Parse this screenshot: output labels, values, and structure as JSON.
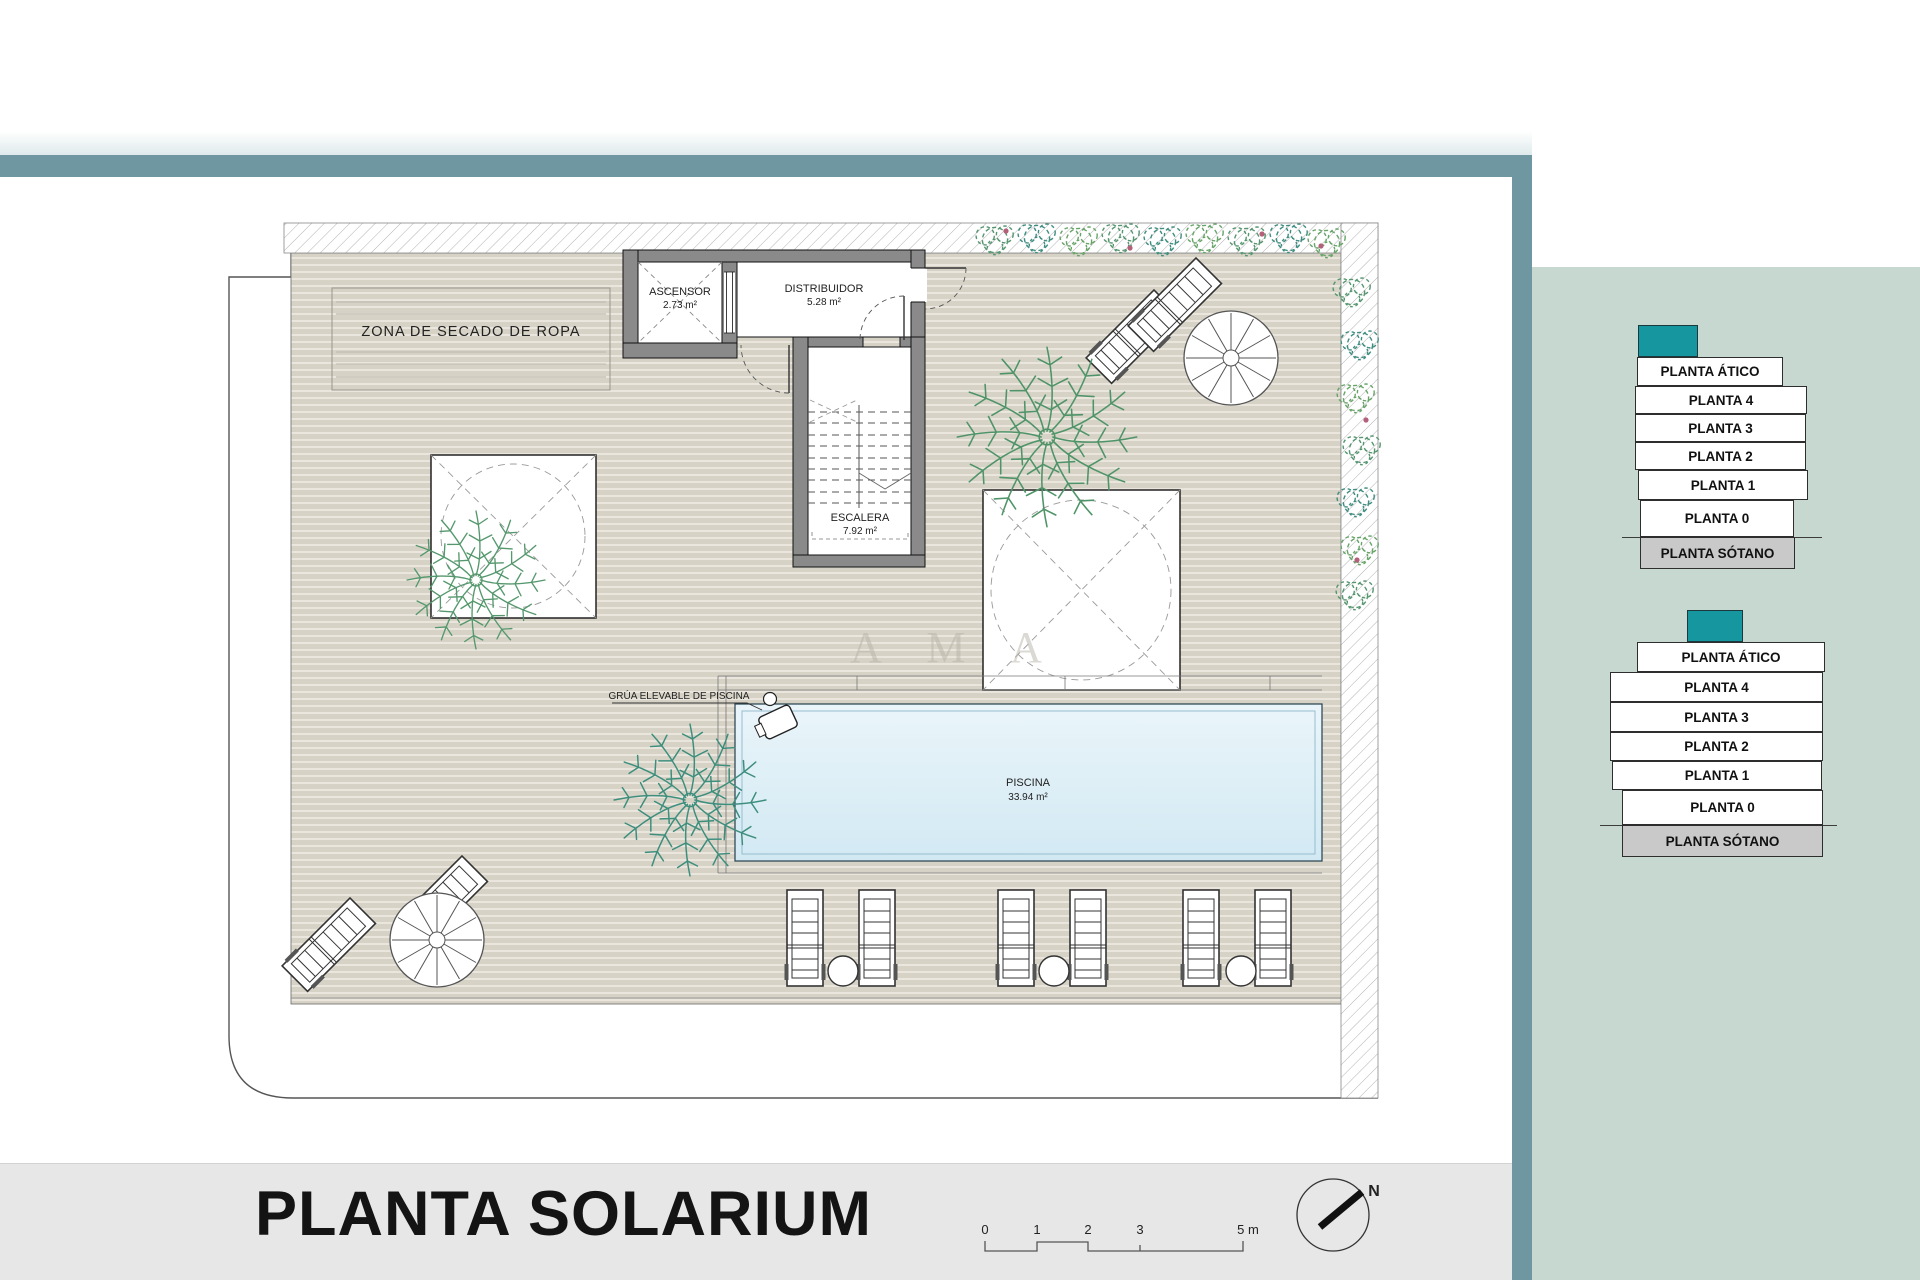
{
  "title": "PLANTA SOLARIUM",
  "watermark": "A M A",
  "plan": {
    "zona_secado": "ZONA DE SECADO DE ROPA",
    "ascensor": {
      "name": "ASCENSOR",
      "area": "2.73 m²"
    },
    "distribuidor": {
      "name": "DISTRIBUIDOR",
      "area": "5.28 m²"
    },
    "escalera": {
      "name": "ESCALERA",
      "area": "7.92 m²"
    },
    "piscina": {
      "name": "PISCINA",
      "area": "33.94 m²"
    },
    "grua": "GRÚA ELEVABLE DE PISCINA"
  },
  "north": {
    "label": "N"
  },
  "scale_bar": {
    "ticks": [
      "0",
      "1",
      "2",
      "3",
      "5 m"
    ]
  },
  "floor_stacks": [
    {
      "name": "stack-small",
      "levels": [
        "PLANTA ÁTICO",
        "PLANTA 4",
        "PLANTA 3",
        "PLANTA 2",
        "PLANTA 1",
        "PLANTA 0",
        "PLANTA SÓTANO"
      ]
    },
    {
      "name": "stack-large",
      "levels": [
        "PLANTA ÁTICO",
        "PLANTA 4",
        "PLANTA 3",
        "PLANTA 2",
        "PLANTA 1",
        "PLANTA 0",
        "PLANTA SÓTANO"
      ]
    }
  ],
  "colors": {
    "accent_teal": "#1697a0",
    "slate_bar": "#6f97a1",
    "sage_panel": "#c7d8d1",
    "sotano_gray": "#c9c9c9",
    "pool_blue": "#dceef6",
    "deck_beige": "#d6d2c6",
    "bottom_strip": "#e7e7e7"
  }
}
